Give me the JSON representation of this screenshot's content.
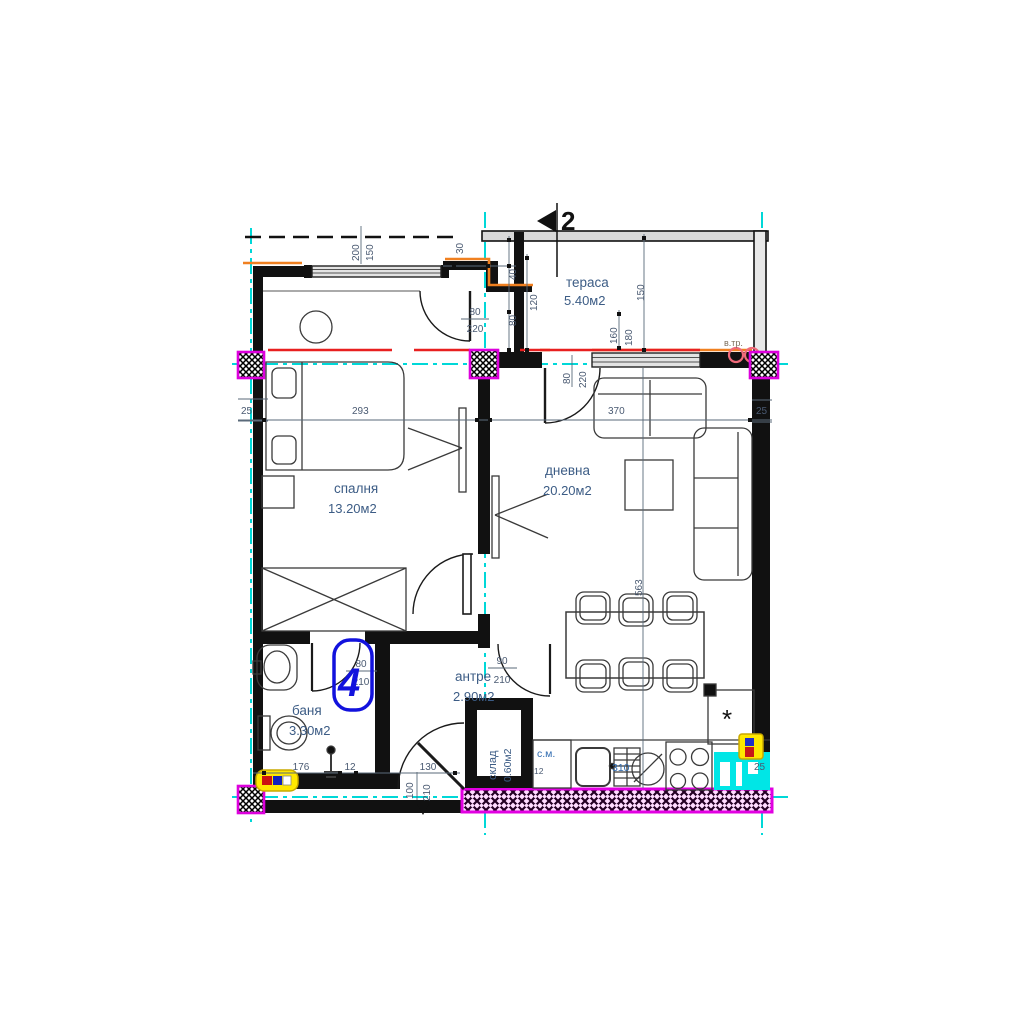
{
  "section_marker": {
    "number": "2"
  },
  "rooms": {
    "terrace": {
      "name": "тераса",
      "area": "5.40м2"
    },
    "bedroom": {
      "name": "спалня",
      "area": "13.20м2"
    },
    "living": {
      "name": "дневна",
      "area": "20.20м2"
    },
    "bath": {
      "name": "баня",
      "area": "3.30м2"
    },
    "hall": {
      "name": "антре",
      "area": "2.90м2"
    },
    "storage": {
      "name": "склад",
      "area": "0.60м2"
    }
  },
  "windows": {
    "bedroom": {
      "w": "200",
      "h": "150"
    },
    "living": {
      "w": "160",
      "h": "180"
    }
  },
  "doors": {
    "bedroom_terrace": {
      "w": "80",
      "h": "220"
    },
    "living_terrace": {
      "w": "80",
      "h": "220"
    },
    "bathroom": {
      "w": "80",
      "h": "210"
    },
    "hall_living": {
      "w": "90",
      "h": "210"
    },
    "entrance": {
      "w": "100",
      "h": "210"
    }
  },
  "dims": {
    "d30": "30",
    "d40": "40",
    "d120": "120",
    "d80": "80",
    "d150": "150",
    "wall_left": "25",
    "wall_right": "25",
    "wall_bottom_right": "25",
    "bedroom_width": "293",
    "living_width": "370",
    "living_length": "563",
    "bath_a": "176",
    "bath_b": "12",
    "hall_w": "130",
    "counter": "310",
    "wm_d": "12"
  },
  "annotations": {
    "vent_pipe": "в.тр.",
    "washing_machine": "с.м.",
    "revision_cloud": "4",
    "fridge_spot": "*"
  },
  "colors": {
    "axis": "#00d8d8",
    "column": "#dd00dd",
    "sill": "#f08020",
    "alert": "#e82020",
    "revision": "#1212dd",
    "highlight": "#00e6e6",
    "panel": "#ffe800"
  }
}
